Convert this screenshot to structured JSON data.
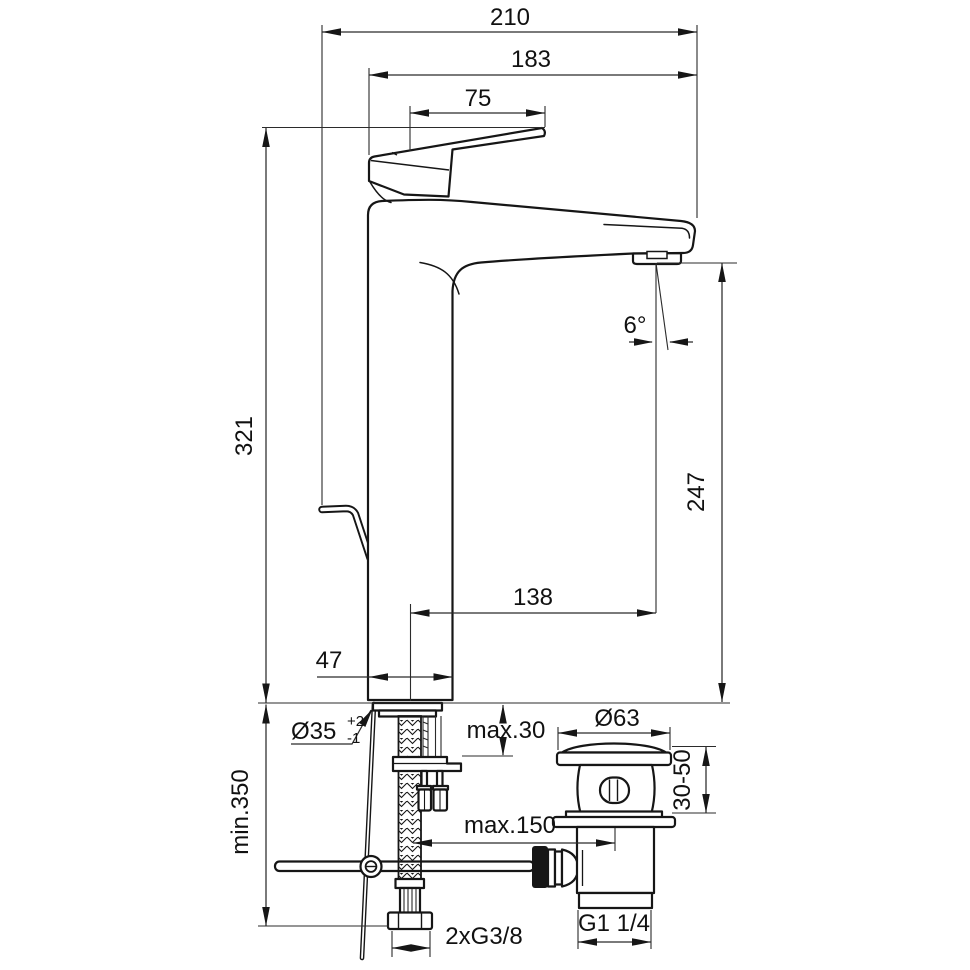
{
  "drawing": {
    "product": "single-lever tall basin mixer with pop-up waste, dimensional drawing",
    "units": "mm",
    "labels": {
      "overall_depth": "210",
      "spout_depth": "183",
      "handle_depth": "75",
      "body_height": "321",
      "spout_height": "247",
      "spout_reach": "138",
      "spout_angle": "6°",
      "base_width": "47",
      "hole_diameter": "Ø35",
      "hole_tol_upper": "+2",
      "hole_tol_lower": "-1",
      "deck_thickness": "max.30",
      "clearance_below": "min.350",
      "drain_offset": "max.150",
      "supply_thread": "2xG3/8",
      "waste_cap_diameter": "Ø63",
      "waste_height_range": "30-50",
      "waste_thread": "G1 1/4"
    }
  }
}
